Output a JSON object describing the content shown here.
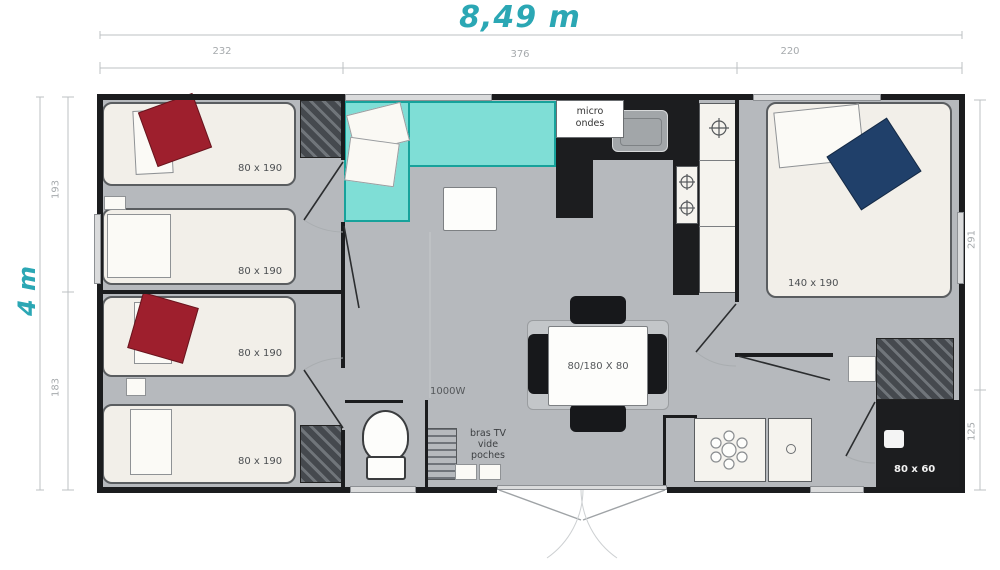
{
  "plan": {
    "title_width": "8,49 m",
    "title_height": "4 m",
    "dims": {
      "top": [
        "232",
        "376",
        "220"
      ],
      "left": [
        "193",
        "183"
      ],
      "right": [
        "291",
        "125"
      ]
    },
    "beds": [
      {
        "label": "80 x 190"
      },
      {
        "label": "80 x 190"
      },
      {
        "label": "80 x 190"
      },
      {
        "label": "80 x 190"
      },
      {
        "label": "140 x 190"
      }
    ],
    "kitchen": {
      "microwave": "micro\nondes"
    },
    "living": {
      "heater": "1000W",
      "shelf": "bras TV\nvide\npoches"
    },
    "dining": {
      "table": "80/180 X 80"
    },
    "bathroom": {
      "shower": "80 x 60"
    },
    "colors": {
      "accent": "#2ba7b4",
      "sofa": "#7fded6",
      "blanket_red": "#9e1f2d",
      "blanket_blue": "#20406a",
      "wall": "#1b1c1e",
      "floor": "#b6b9bd"
    }
  }
}
